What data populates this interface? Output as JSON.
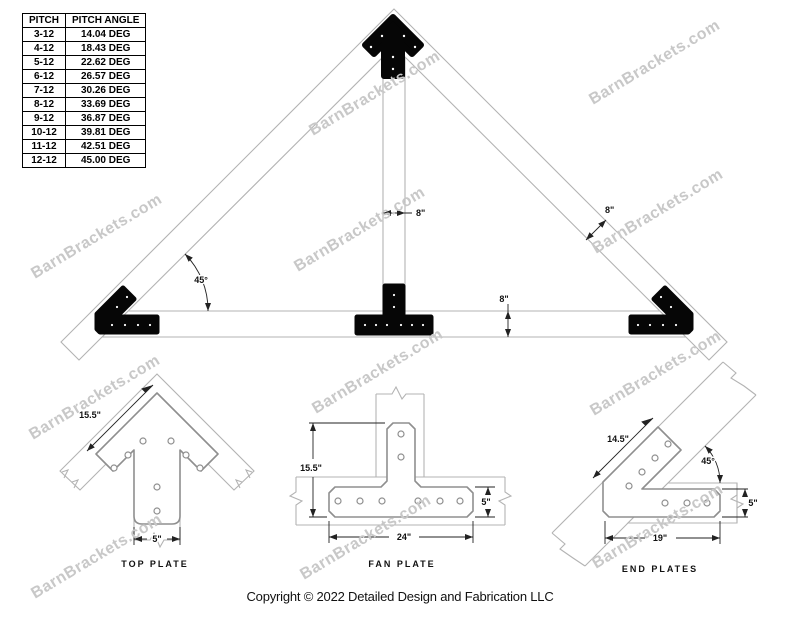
{
  "watermark": {
    "text": "BarnBrackets.com",
    "color": "#c8c8c8"
  },
  "pitch_table": {
    "headers": [
      "PITCH",
      "PITCH ANGLE"
    ],
    "rows": [
      {
        "pitch": "3-12",
        "angle": "14.04 DEG"
      },
      {
        "pitch": "4-12",
        "angle": "18.43 DEG"
      },
      {
        "pitch": "5-12",
        "angle": "22.62 DEG"
      },
      {
        "pitch": "6-12",
        "angle": "26.57 DEG"
      },
      {
        "pitch": "7-12",
        "angle": "30.26 DEG"
      },
      {
        "pitch": "8-12",
        "angle": "33.69 DEG"
      },
      {
        "pitch": "9-12",
        "angle": "36.87 DEG"
      },
      {
        "pitch": "10-12",
        "angle": "39.81 DEG"
      },
      {
        "pitch": "11-12",
        "angle": "42.51 DEG"
      },
      {
        "pitch": "12-12",
        "angle": "45.00 DEG"
      }
    ]
  },
  "truss": {
    "labels": {
      "post_width": "8\"",
      "rafter_width": "8\"",
      "chord_depth": "8\"",
      "corner_angle": "45°"
    }
  },
  "details": {
    "top_plate": {
      "caption": "TOP PLATE",
      "edge_length": "15.5\"",
      "tail_width": "5\""
    },
    "fan_plate": {
      "caption": "FAN PLATE",
      "height": "15.5\"",
      "width": "24\"",
      "bar_height": "5\""
    },
    "end_plates": {
      "caption": "END PLATES",
      "edge_length": "14.5\"",
      "angle": "45°",
      "bar_height": "5\"",
      "width": "19\""
    }
  },
  "footer": {
    "copyright": "Copyright © 2022 Detailed Design and Fabrication LLC"
  },
  "colors": {
    "beam_line": "#b3b3b3",
    "plate_outline": "#8f8f8f",
    "dimension": "#222222",
    "bracket_fill": "#060606",
    "watermark": "#c8c8c8"
  }
}
